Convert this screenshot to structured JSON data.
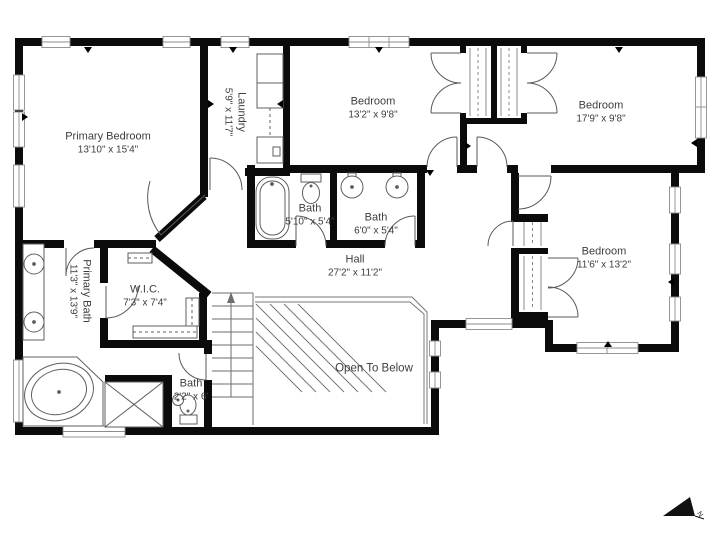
{
  "plan": {
    "rooms": [
      {
        "id": "primary-bedroom",
        "name": "Primary Bedroom",
        "dims": "13'10\" x 15'4\""
      },
      {
        "id": "laundry",
        "name": "Laundry",
        "dims": "5'9\" x 11'7\"",
        "rotated": true
      },
      {
        "id": "bedroom-top-middle",
        "name": "Bedroom",
        "dims": "13'2\" x 9'8\""
      },
      {
        "id": "bedroom-top-right",
        "name": "Bedroom",
        "dims": "17'9\" x 9'8\""
      },
      {
        "id": "bath-tub",
        "name": "Bath",
        "dims": "5'10\" x 5'4\""
      },
      {
        "id": "bath-double",
        "name": "Bath",
        "dims": "6'0\" x 5'4\""
      },
      {
        "id": "hall",
        "name": "Hall",
        "dims": "27'2\" x 11'2\""
      },
      {
        "id": "bedroom-right",
        "name": "Bedroom",
        "dims": "11'6\" x 13'2\""
      },
      {
        "id": "primary-bath",
        "name": "Primary Bath",
        "dims": "11'3\" x 13'9\"",
        "rotated": true
      },
      {
        "id": "wic",
        "name": "W.I.C.",
        "dims": "7'3\" x 7'4\""
      },
      {
        "id": "bath-small",
        "name": "Bath",
        "dims": "2'2\" x 6'"
      }
    ],
    "annotations": {
      "open_to_below": "Open To Below",
      "compass_label": "N"
    },
    "colors": {
      "wall": "#0b0b0b",
      "line": "#5a5a5a",
      "text": "#3d3d3d",
      "background": "#ffffff"
    }
  }
}
